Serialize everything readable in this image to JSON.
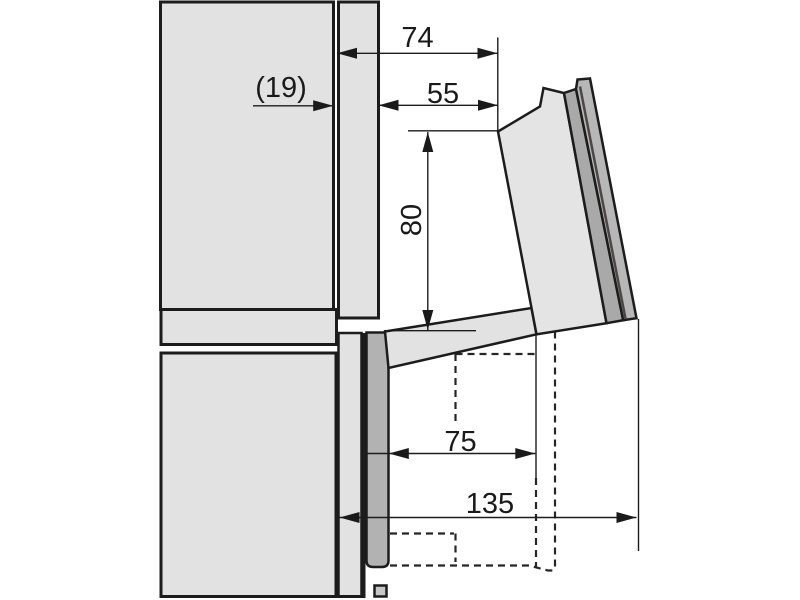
{
  "diagram": {
    "type": "appliance-installation-side-view",
    "labels": {
      "dim_74": "74",
      "dim_19": "(19)",
      "dim_55": "55",
      "dim_80": "80",
      "dim_75": "75",
      "dim_135": "135"
    },
    "colors": {
      "background": "#ffffff",
      "cabinet_fill": "#e2e2e2",
      "closed_door_fill": "#b2b2b2",
      "door_strip_inner": "#a9a9a9",
      "door_strip_outer": "#b7b7b7",
      "outline": "#1c1c1c",
      "divider_line": "#4e4646"
    }
  }
}
